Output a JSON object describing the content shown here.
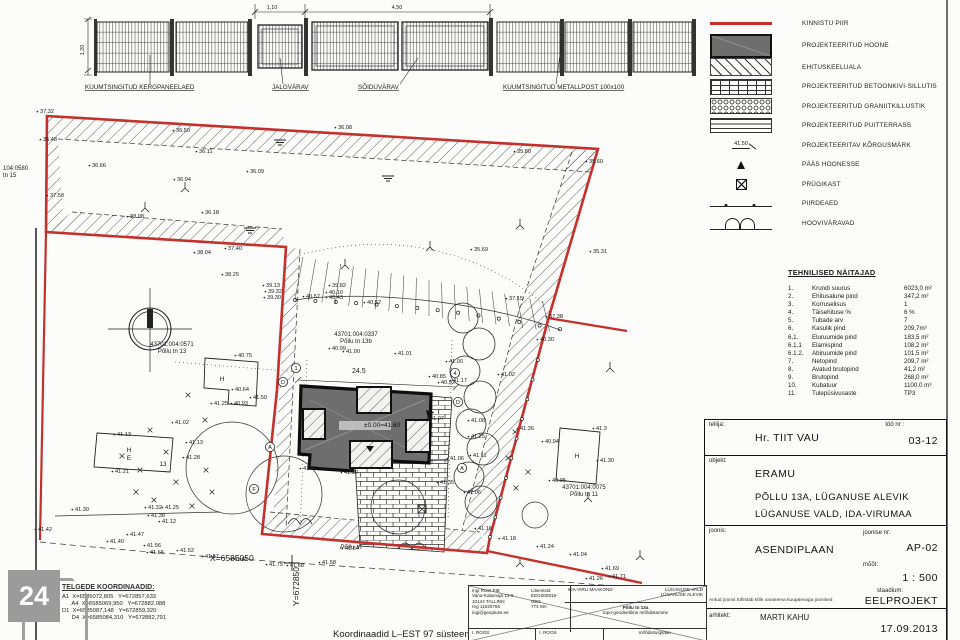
{
  "colors": {
    "boundary_red": "#c4302b",
    "building_gray": "#6e6e6e",
    "paper": "#fcfcfb",
    "ink": "#1a1a1a"
  },
  "fence": {
    "labels": [
      {
        "x": 85,
        "y": 89,
        "t": "KUUMTSINGITUD KERGPANEELAED"
      },
      {
        "x": 272,
        "y": 89,
        "t": "JALGVÄRAV"
      },
      {
        "x": 358,
        "y": 89,
        "t": "SÕIDUVÄRAV"
      },
      {
        "x": 503,
        "y": 89,
        "t": "KUUMTSINGITUD METALLPOST 100x100"
      }
    ],
    "dims": {
      "height": "1,20",
      "gate_small": "1,10",
      "gate_large": "4,50"
    }
  },
  "legend": {
    "items": [
      {
        "swatch": "red-line",
        "label": "KINNISTU PIIR"
      },
      {
        "swatch": "building",
        "label": "PROJEKTEERITUD HOONE"
      },
      {
        "swatch": "hatch",
        "label": "EHITUSKEELUALA"
      },
      {
        "swatch": "brick",
        "label": "PROJEKTEERITUD BETOONKIVI-SILLUTIS"
      },
      {
        "swatch": "gravel",
        "label": "PROJEKTEERITUD GRANIITKILLUSTIK"
      },
      {
        "swatch": "deck",
        "label": "PROJEKTEERITUD PUITTERRASS"
      },
      {
        "swatch": "mark",
        "label": "PROJEKTEERITAV KÕRGUSMÄRK",
        "swatch_text": "41.50"
      },
      {
        "swatch": "triangle",
        "label": "PÄÄS HOONESSE"
      },
      {
        "swatch": "bin",
        "label": "PRÜGIKAST"
      },
      {
        "swatch": "fence",
        "label": "PIIRDEAED"
      },
      {
        "swatch": "gate",
        "label": "HOOVIVÄRAVAD"
      }
    ]
  },
  "technical": {
    "title": "TEHNILISED NÄITAJAD",
    "rows": [
      {
        "no": "1.",
        "name": "Krundi suurus",
        "value": "6023,0 m²"
      },
      {
        "no": "2.",
        "name": "Ehitusalune pind",
        "value": "347,2 m²"
      },
      {
        "no": "3.",
        "name": "Korruselisus",
        "value": "1"
      },
      {
        "no": "4.",
        "name": "Täisehituse %",
        "value": "6 %"
      },
      {
        "no": "5.",
        "name": "Tubade arv",
        "value": "7"
      },
      {
        "no": "6.",
        "name": "Kasulik pind",
        "value": "209,7m²"
      },
      {
        "no": "6,1.",
        "name": "Eluruumide pind",
        "value": "183,5 m²"
      },
      {
        "no": "6.1.1",
        "name": "Elamispind",
        "value": "108,2 m²"
      },
      {
        "no": "6.1.2.",
        "name": "Abiruumide pind",
        "value": "101,5 m²"
      },
      {
        "no": "7.",
        "name": "Netopind",
        "value": "209,7 m²"
      },
      {
        "no": "8.",
        "name": "Avatud brutopind",
        "value": "41,2 m²"
      },
      {
        "no": "9.",
        "name": "Brutopind",
        "value": "268,0 m²"
      },
      {
        "no": "10.",
        "name": "Kubatuur",
        "value": "1100,0 m³"
      },
      {
        "no": "11.",
        "name": "Tulepüsivusaste",
        "value": "TP3"
      }
    ]
  },
  "titleblock": {
    "tellija_label": "tellija:",
    "tellija": "Hr. TIIT VAU",
    "too_nr_label": "töö nr :",
    "too_nr": "03-12",
    "objekt_label": "objekt:",
    "objekt_line1": "ERAMU",
    "objekt_line2": "PÕLLU 13A, LÜGANUSE ALEVIK",
    "objekt_line3": "LÜGANUSE VALD, IDA-VIRUMAA",
    "joonis_label": "joonis:",
    "joonis": "ASENDIPLAAN",
    "joonise_nr_label": "joonise nr:",
    "joonise_nr": "AP-02",
    "moot_label": "mõõt:",
    "moot": "1 : 500",
    "staadium_label": "staadium:",
    "staadium": "EELPROJEKT",
    "note": "Antud joonis tühistab kõik varasema kuupäevaga joonised",
    "arhitekt_label": "arhitekt:",
    "arhitekt": "MARTI KAHU",
    "date": "17.09.2013"
  },
  "stamp": {
    "firm": [
      "Ingi Roos FIE",
      "Vana-Kalamaja 13-5",
      "10144 TALLINN",
      "reg 11620765",
      "ingi@geopluss.ee"
    ],
    "licenses": [
      "Litsentsid",
      "EEG000916-0001",
      "774 MA"
    ],
    "county": "IDA-VIRU MAAKOND",
    "municipality": "LÜGANUSE VALD",
    "settlement": "LÜGANUSE ALEVIK",
    "site": "Põllu tn 13a",
    "work": "topo-geodeetiline mõõdistamine",
    "surveyed": "I. ROOS",
    "drawn": "I. ROOS",
    "drawing_name": "mõõdistusplaan"
  },
  "axes_coords": {
    "title": "TELGEDE KOORDINAADID:",
    "lines": [
      "A1  X=6585072,805   Y=672857,633",
      "      A4  X=6585069,950   Y=672882,088",
      "D1  X=6585087,148   Y=672859,320",
      "      D4  X=6585084,310   Y=672882,791"
    ]
  },
  "logo_text": "24",
  "plan": {
    "cadastral_labels": [
      {
        "x": 172,
        "y": 346,
        "a": "m",
        "l1": "43701:004:0571",
        "l2": "Põllu tn 13"
      },
      {
        "x": 356,
        "y": 336,
        "a": "m",
        "l1": "43701:004:0337",
        "l2": "Põllu tn 13b"
      },
      {
        "x": 584,
        "y": 489,
        "a": "m",
        "l1": "43701:004:0075",
        "l2": "Põllu tn 11"
      },
      {
        "x": 3,
        "y": 170,
        "a": "s",
        "l1": "104:0580",
        "l2": "tn 15"
      }
    ],
    "house_labels": [
      {
        "x": 222,
        "y": 381,
        "t": "H"
      },
      {
        "x": 129,
        "y": 452,
        "t": "H"
      },
      {
        "x": 129,
        "y": 460,
        "t": "E"
      },
      {
        "x": 163,
        "y": 466,
        "t": "13"
      },
      {
        "x": 577,
        "y": 458,
        "t": "H"
      }
    ],
    "axis_bubbles": [
      {
        "x": 296,
        "y": 368,
        "t": "1"
      },
      {
        "x": 455,
        "y": 373,
        "t": "4"
      },
      {
        "x": 283,
        "y": 382,
        "t": "D"
      },
      {
        "x": 270,
        "y": 447,
        "t": "A"
      },
      {
        "x": 254,
        "y": 489,
        "t": "F"
      },
      {
        "x": 458,
        "y": 402,
        "t": "D"
      },
      {
        "x": 462,
        "y": 468,
        "t": "A"
      }
    ],
    "misc_texts": [
      {
        "x": 352,
        "y": 373,
        "t": "24.5",
        "cls": "dim"
      },
      {
        "x": 364,
        "y": 427,
        "t": "±0.00=41.60",
        "cls": "lvl"
      },
      {
        "x": 210,
        "y": 561,
        "t": "X=6585050",
        "cls": "coord"
      },
      {
        "x": 340,
        "y": 549,
        "t": "Põllu tn",
        "cls": "street"
      },
      {
        "x": 333,
        "y": 637,
        "t": "Koordinaadid L–EST 97 süsteemis",
        "cls": "coordbig"
      },
      {
        "x": 299,
        "y": 606,
        "t": "Y=672850",
        "cls": "coord",
        "rot": -90
      }
    ],
    "spot_elevations": [
      [
        40,
        113,
        "37.32"
      ],
      [
        43,
        141,
        "36.48"
      ],
      [
        50,
        197,
        "37.58"
      ],
      [
        92,
        167,
        "36.66"
      ],
      [
        176,
        132,
        "36.50"
      ],
      [
        199,
        153,
        "36.11"
      ],
      [
        177,
        181,
        "36.94"
      ],
      [
        250,
        173,
        "36.09"
      ],
      [
        205,
        214,
        "36.18"
      ],
      [
        130,
        218,
        "38.08"
      ],
      [
        338,
        129,
        "36.08"
      ],
      [
        517,
        153,
        "35.80"
      ],
      [
        589,
        163,
        "35.60"
      ],
      [
        228,
        250,
        "37.40"
      ],
      [
        197,
        254,
        "38.04"
      ],
      [
        225,
        276,
        "38.25"
      ],
      [
        474,
        251,
        "35.69"
      ],
      [
        593,
        253,
        "35.31"
      ],
      [
        509,
        300,
        "37.15"
      ],
      [
        549,
        318,
        "37.38"
      ],
      [
        540,
        341,
        "40.30"
      ],
      [
        332,
        287,
        "39.82"
      ],
      [
        329,
        294,
        "40.10"
      ],
      [
        306,
        298,
        "40.57"
      ],
      [
        329,
        299,
        "40.43"
      ],
      [
        367,
        304,
        "40.52"
      ],
      [
        266,
        287,
        "39.13"
      ],
      [
        268,
        293,
        "39.32"
      ],
      [
        267,
        299,
        "39.30"
      ],
      [
        332,
        350,
        "40.99"
      ],
      [
        346,
        353,
        "41.00"
      ],
      [
        398,
        355,
        "41.01"
      ],
      [
        238,
        357,
        "40.75"
      ],
      [
        235,
        391,
        "40.64"
      ],
      [
        214,
        405,
        "41.25"
      ],
      [
        234,
        405,
        "40.93"
      ],
      [
        117,
        436,
        "41.13"
      ],
      [
        175,
        424,
        "41.02"
      ],
      [
        189,
        444,
        "41.13"
      ],
      [
        186,
        459,
        "41.28"
      ],
      [
        115,
        473,
        "41.21"
      ],
      [
        75,
        511,
        "41.30"
      ],
      [
        148,
        509,
        "41.32"
      ],
      [
        165,
        509,
        "41.25"
      ],
      [
        151,
        517,
        "41.38"
      ],
      [
        162,
        523,
        "41.12"
      ],
      [
        130,
        536,
        "41.47"
      ],
      [
        38,
        531,
        "41.42"
      ],
      [
        110,
        543,
        "41.40"
      ],
      [
        147,
        547,
        "41.56"
      ],
      [
        150,
        554,
        "41.66"
      ],
      [
        180,
        552,
        "41.52"
      ],
      [
        205,
        558,
        "41.57"
      ],
      [
        234,
        561,
        "41.62"
      ],
      [
        269,
        566,
        "41.75"
      ],
      [
        290,
        567,
        "41.68"
      ],
      [
        322,
        564,
        "41.58"
      ],
      [
        449,
        363,
        "41.00"
      ],
      [
        453,
        382,
        "41.17"
      ],
      [
        501,
        376,
        "41.02"
      ],
      [
        432,
        378,
        "40.85"
      ],
      [
        441,
        384,
        "40.92"
      ],
      [
        430,
        420,
        "41.07"
      ],
      [
        471,
        422,
        "41.08"
      ],
      [
        471,
        438,
        "41.25"
      ],
      [
        473,
        457,
        "41.11"
      ],
      [
        450,
        460,
        "41.06"
      ],
      [
        467,
        494,
        "41.06"
      ],
      [
        440,
        484,
        "41.35"
      ],
      [
        520,
        430,
        "41.36"
      ],
      [
        545,
        443,
        "40.94"
      ],
      [
        502,
        540,
        "41.18"
      ],
      [
        478,
        530,
        "41.16"
      ],
      [
        540,
        548,
        "41.24"
      ],
      [
        573,
        556,
        "41.04"
      ],
      [
        589,
        580,
        "41.26"
      ],
      [
        605,
        570,
        "41.69"
      ],
      [
        612,
        578,
        "41.71"
      ],
      [
        345,
        550,
        "41.54"
      ],
      [
        596,
        430,
        "41.3"
      ],
      [
        552,
        482,
        "40.95"
      ],
      [
        600,
        462,
        "41.30"
      ],
      [
        253,
        399,
        "41.50"
      ],
      [
        303,
        470,
        "41.50"
      ],
      [
        344,
        474,
        "41.50"
      ]
    ]
  }
}
